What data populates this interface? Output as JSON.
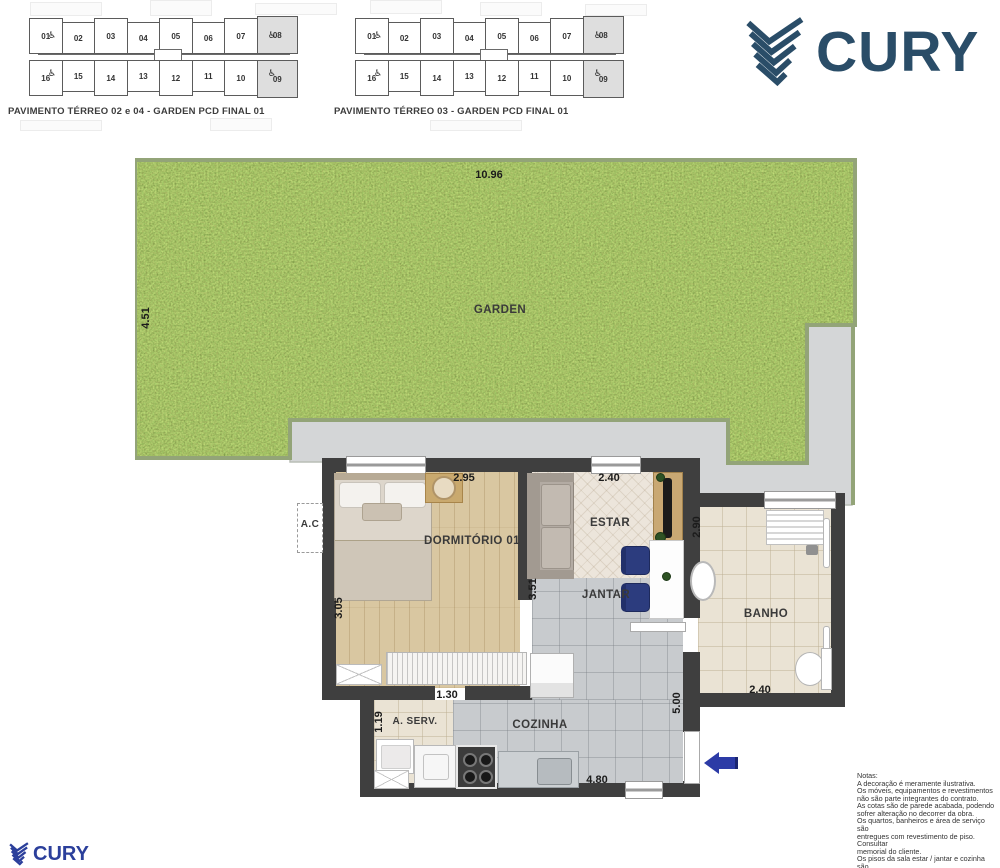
{
  "logo": {
    "text": "CURY",
    "color_top": "#2a4d68",
    "color_bottom": "#2b3f9b"
  },
  "icons": {
    "wheelchair": "♿",
    "entry_arrow": "left-arrow"
  },
  "colors": {
    "wall": "#3f3f3f",
    "grass": "#5a7c37",
    "patio": "#d4d6d7",
    "arrow": "#2c3ba6",
    "chair": "#2c3c7e"
  },
  "keyplans": [
    {
      "caption": "PAVIMENTO TÉRREO 02 e 04 - GARDEN PCD FINAL 01",
      "top_units": [
        "01",
        "02",
        "03",
        "04",
        "05",
        "06",
        "07",
        "08"
      ],
      "bottom_units": [
        "16",
        "15",
        "14",
        "13",
        "12",
        "11",
        "10",
        "09"
      ]
    },
    {
      "caption": "PAVIMENTO TÉRREO 03 - GARDEN PCD FINAL 01",
      "top_units": [
        "01",
        "02",
        "03",
        "04",
        "05",
        "06",
        "07",
        "08"
      ],
      "bottom_units": [
        "16",
        "15",
        "14",
        "13",
        "12",
        "11",
        "10",
        "09"
      ]
    }
  ],
  "garden": {
    "label": "GARDEN",
    "width_dim": "10.96",
    "depth_dim": "4.51"
  },
  "rooms": {
    "dormitorio": "DORMITÓRIO 01",
    "estar": "ESTAR",
    "jantar": "JANTAR",
    "banho": "BANHO",
    "cozinha": "COZINHA",
    "aserv": "A. SERV.",
    "ac": "A.C"
  },
  "dims": {
    "dorm_w": "2.95",
    "dorm_d": "3.05",
    "estar_w": "2.40",
    "sala_d": "3.51",
    "banho_d": "2.90",
    "banho_w": "2.40",
    "coz_d": "5.00",
    "coz_w": "4.80",
    "aserv_w": "1.30",
    "aserv_d": "1.19"
  },
  "notes": {
    "lines": [
      "Notas:",
      "A decoração é meramente ilustrativa.",
      "Os móveis, equipamentos e revestimentos",
      "não são parte integrantes do contrato.",
      "As cotas são de parede acabada, podendo",
      "sofrer alteração no decorrer da obra.",
      "Os quartos, banheiros e área de serviço são",
      "entregues com revestimento de piso. Consultar",
      "memorial do cliente.",
      "Os pisos da sala estar / jantar e cozinha são",
      "meramente ilustrativos. Consultar memorial do",
      "cliente."
    ]
  }
}
